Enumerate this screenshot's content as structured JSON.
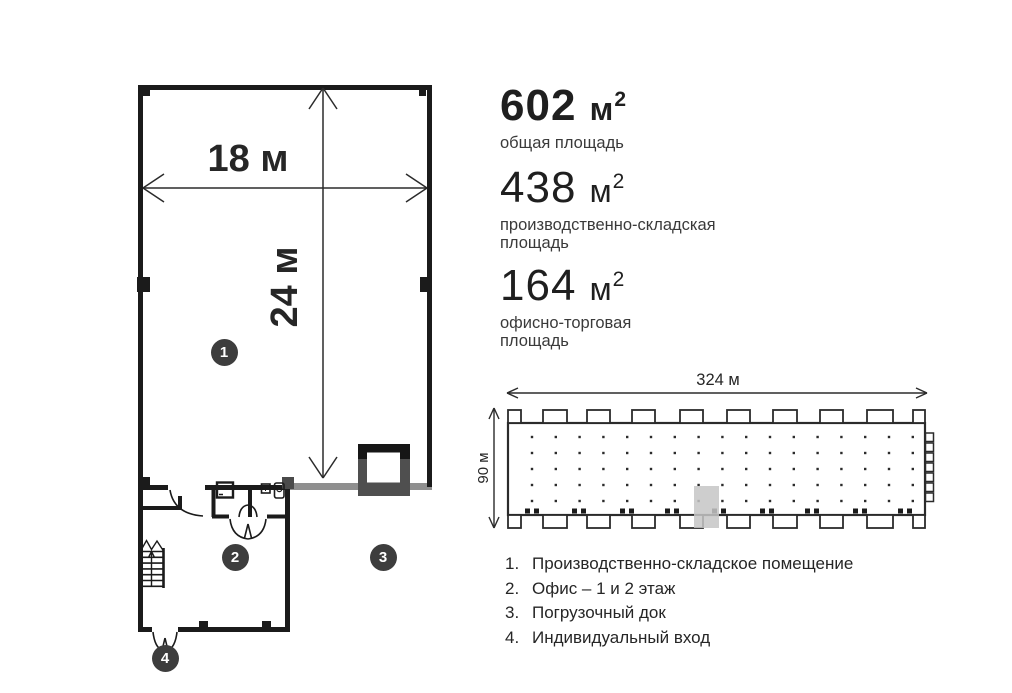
{
  "stats": [
    {
      "value": "602",
      "unit": "м",
      "sup": "2",
      "label": "общая площадь"
    },
    {
      "value": "438",
      "unit": "м",
      "sup": "2",
      "label": "производственно-складская площадь"
    },
    {
      "value": "164",
      "unit": "м",
      "sup": "2",
      "label": "офисно-торговая площадь"
    }
  ],
  "floor_plan": {
    "width_label": "18 м",
    "height_label": "24 м",
    "markers": [
      {
        "n": "1"
      },
      {
        "n": "2"
      },
      {
        "n": "3"
      },
      {
        "n": "4"
      }
    ]
  },
  "site_plan": {
    "width_label": "324 м",
    "height_label": "90 м",
    "grid": {
      "cols": 17,
      "rows": 5
    }
  },
  "legend": {
    "items": [
      {
        "num": "1.",
        "text": "Производственно-складское помещение"
      },
      {
        "num": "2.",
        "text": "Офис – 1 и 2 этаж"
      },
      {
        "num": "3.",
        "text": "Погрузочный док"
      },
      {
        "num": "4.",
        "text": "Индивидуальный вход"
      }
    ]
  },
  "colors": {
    "wall": "#1b1b1b",
    "gray_wall": "#8f8f8f",
    "dock_gray": "#4f4f4f",
    "marker_bg": "#3d3d3d",
    "highlight": "#c6c6c6",
    "line": "#2b2b2b"
  }
}
